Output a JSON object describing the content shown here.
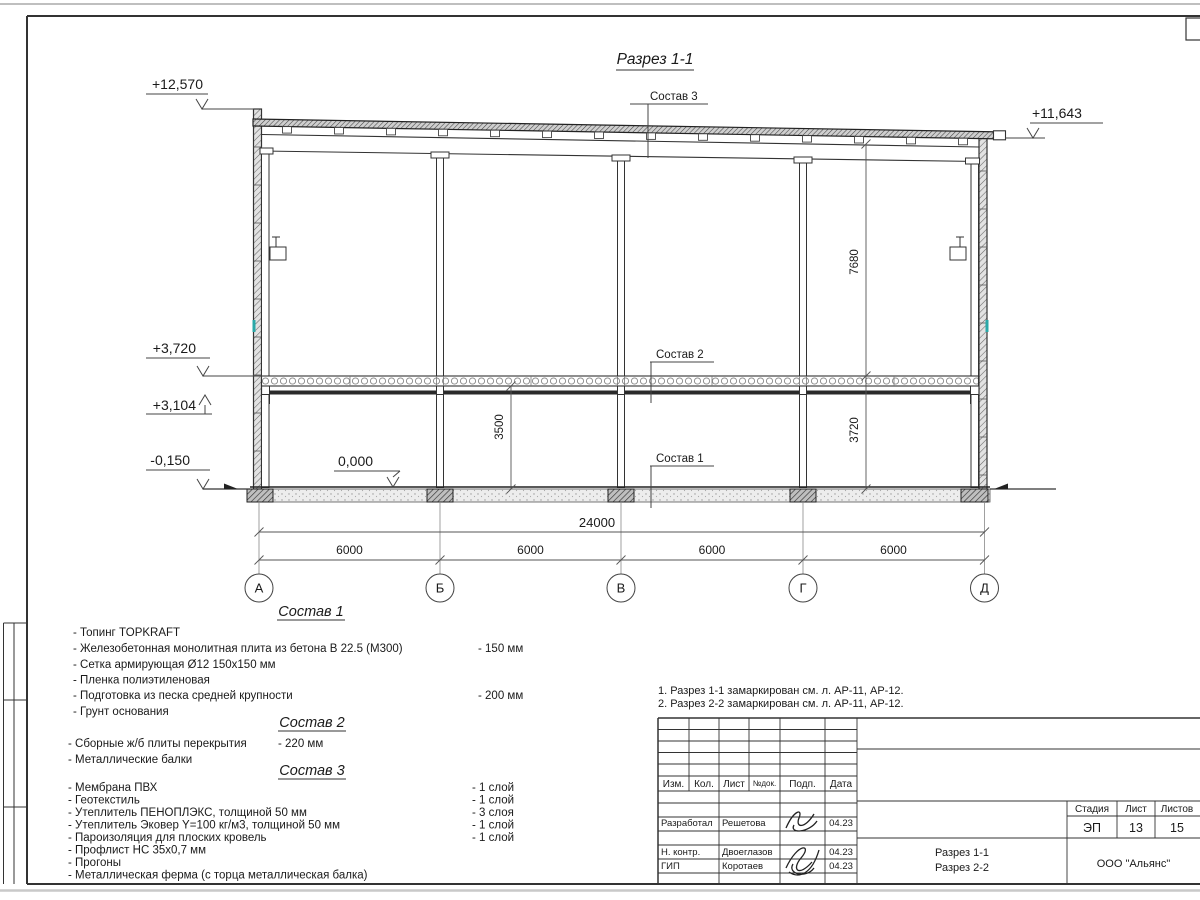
{
  "drawing_title": "Разрез 1-1",
  "elevations": {
    "parapet": "+12,570",
    "eaves": "+11,643",
    "slab_top": "+3,720",
    "beam_bottom": "+3,104",
    "ground": "-0,150",
    "floor_zero": "0,000"
  },
  "callouts": {
    "c3": "Состав 3",
    "c2": "Состав 2",
    "c1": "Состав 1"
  },
  "dims": {
    "total": "24000",
    "bays": [
      "6000",
      "6000",
      "6000",
      "6000"
    ],
    "truss_height": "7680",
    "clear_height": "3500",
    "storey_height": "3720"
  },
  "axes": [
    "А",
    "Б",
    "В",
    "Г",
    "Д"
  ],
  "compositions": [
    {
      "title": "Состав 1",
      "items": [
        {
          "t": "- Топинг TOPKRAFT",
          "v": ""
        },
        {
          "t": "- Железобетонная  монолитная плита из бетона  В 22.5 (М300)",
          "v": "- 150 мм"
        },
        {
          "t": "- Сетка армирующая Ø12 150х150 мм",
          "v": ""
        },
        {
          "t": "- Пленка полиэтиленовая",
          "v": ""
        },
        {
          "t": "- Подготовка из песка средней  крупности",
          "v": "- 200 мм"
        },
        {
          "t": "- Грунт основания",
          "v": ""
        }
      ]
    },
    {
      "title": "Состав 2",
      "items": [
        {
          "t": "- Сборные ж/б плиты перекрытия",
          "v": "- 220 мм"
        },
        {
          "t": "- Металлические балки",
          "v": ""
        }
      ]
    },
    {
      "title": "Состав 3",
      "items": [
        {
          "t": "- Мембрана ПВХ",
          "v": "- 1 слой"
        },
        {
          "t": "- Геотекстиль",
          "v": "- 1 слой"
        },
        {
          "t": "- Утеплитель ПЕНОПЛЭКС, толщиной 50 мм",
          "v": "- 3 слоя"
        },
        {
          "t": "- Утеплитель Эковер Y=100 кг/м3, толщиной 50 мм",
          "v": "- 1 слой"
        },
        {
          "t": "- Пароизоляция для плоских кровель",
          "v": "- 1 слой"
        },
        {
          "t": "- Профлист НС 35х0,7 мм",
          "v": ""
        },
        {
          "t": "- Прогоны",
          "v": ""
        },
        {
          "t": "- Металлическая ферма (с торца металлическая балка)",
          "v": ""
        }
      ]
    }
  ],
  "notes": [
    "1. Разрез 1-1 замаркирован см. л. АР-11, АР-12.",
    "2. Разрез 2-2 замаркирован см. л. АР-11, АР-12."
  ],
  "titleblock": {
    "columns": [
      "Изм.",
      "Кол.",
      "Лист",
      "№док.",
      "Подп.",
      "Дата"
    ],
    "rows": [
      {
        "role": "Разработал",
        "name": "Решетова",
        "date": "04.23"
      },
      {
        "role": "Н. контр.",
        "name": "Двоеглазов",
        "date": "04.23"
      },
      {
        "role": "ГИП",
        "name": "Коротаев",
        "date": "04.23"
      }
    ],
    "stage_label": "Стадия",
    "sheet_label": "Лист",
    "sheets_label": "Листов",
    "stage": "ЭП",
    "sheet": "13",
    "sheets": "15",
    "doc_line1": "Разрез 1-1",
    "doc_line2": "Разрез 2-2",
    "company": "ООО \"Альянс\""
  }
}
